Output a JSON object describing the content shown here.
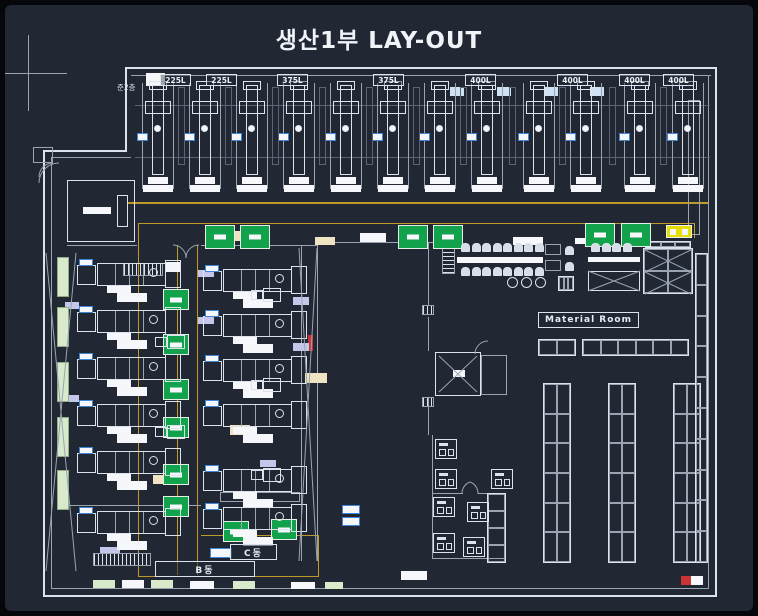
{
  "title": "생산1부 LAY-OUT",
  "labels": {
    "mezzanine": "준2층",
    "material_room": "Material Room",
    "block_b": "B동",
    "block_c": "C동"
  },
  "machine_labels": [
    {
      "x": 155,
      "text": "225L"
    },
    {
      "x": 201,
      "text": "225L"
    },
    {
      "x": 272,
      "text": "375L"
    },
    {
      "x": 368,
      "text": "375L"
    },
    {
      "x": 460,
      "text": "400L"
    },
    {
      "x": 552,
      "text": "400L"
    },
    {
      "x": 614,
      "text": "400L"
    },
    {
      "x": 658,
      "text": "400L"
    }
  ],
  "colors": {
    "bg": "#212834",
    "line": "#dde3ec",
    "dim": "#9aa4b2",
    "dim2": "#5a6472",
    "yellow": "#c09a26",
    "green": "#12a24b",
    "palegreen": "#d8e9cc",
    "blue": "#3f86d8",
    "paleblue": "#cfe2f3",
    "lavender": "#c6c6ea",
    "tan": "#efe3c4",
    "red": "#c93434",
    "white": "#f5f7fa"
  },
  "plan": {
    "crosshair": {
      "h": [
        0,
        68,
        62,
        1
      ],
      "v": [
        23,
        30,
        1,
        76
      ]
    },
    "top_machines": {
      "y": 76,
      "w": 34,
      "h": 112,
      "xs": [
        136,
        183,
        230,
        277,
        324,
        371,
        418,
        465,
        517,
        564,
        618,
        666
      ]
    },
    "side_machines": [
      [
        72,
        252
      ],
      [
        72,
        299
      ],
      [
        72,
        346
      ],
      [
        72,
        393
      ],
      [
        72,
        440
      ],
      [
        72,
        500
      ],
      [
        198,
        258
      ],
      [
        198,
        303
      ],
      [
        198,
        348
      ],
      [
        198,
        393
      ],
      [
        198,
        458
      ],
      [
        198,
        496
      ]
    ],
    "small_machines": [
      [
        430,
        434
      ],
      [
        430,
        464
      ],
      [
        428,
        492
      ],
      [
        428,
        528
      ],
      [
        462,
        497
      ],
      [
        458,
        532
      ],
      [
        486,
        464
      ]
    ],
    "pumps": [
      [
        150,
        330
      ],
      [
        150,
        420
      ],
      [
        246,
        283
      ],
      [
        246,
        373
      ],
      [
        246,
        463
      ]
    ],
    "pallets": [
      [
        200,
        220,
        30,
        24
      ],
      [
        235,
        220,
        30,
        24
      ],
      [
        393,
        220,
        30,
        24
      ],
      [
        428,
        220,
        30,
        24
      ],
      [
        580,
        218,
        30,
        24
      ],
      [
        616,
        218,
        30,
        24
      ],
      [
        158,
        284,
        26,
        21
      ],
      [
        158,
        329,
        26,
        21
      ],
      [
        158,
        374,
        26,
        21
      ],
      [
        158,
        412,
        26,
        21
      ],
      [
        158,
        459,
        26,
        21
      ],
      [
        158,
        491,
        26,
        21
      ],
      [
        218,
        516,
        26,
        21
      ],
      [
        266,
        514,
        26,
        21
      ]
    ],
    "pallet_yellow": [
      661,
      220,
      26,
      13
    ],
    "strips": [
      [
        52,
        252
      ],
      [
        52,
        302
      ],
      [
        52,
        357
      ],
      [
        52,
        412
      ],
      [
        52,
        465
      ]
    ],
    "lines": [
      [
        120,
        62,
        592,
        2,
        "line"
      ],
      [
        126,
        70,
        580,
        1,
        "dim"
      ],
      [
        710,
        62,
        2,
        530,
        "line"
      ],
      [
        703,
        70,
        1,
        514,
        "dim"
      ],
      [
        38,
        590,
        674,
        2,
        "line"
      ],
      [
        46,
        583,
        658,
        1,
        "dim"
      ],
      [
        38,
        145,
        2,
        447,
        "line"
      ],
      [
        46,
        152,
        1,
        431,
        "dim"
      ],
      [
        38,
        145,
        84,
        2,
        "line"
      ],
      [
        46,
        152,
        80,
        1,
        "dim"
      ],
      [
        120,
        62,
        2,
        85,
        "line"
      ],
      [
        130,
        100,
        575,
        1,
        "dim2"
      ],
      [
        130,
        152,
        575,
        1,
        "dim2"
      ],
      [
        122,
        197,
        581,
        2,
        "yellow"
      ],
      [
        133,
        218,
        557,
        1,
        "yellow"
      ],
      [
        133,
        218,
        1,
        354,
        "yellow"
      ],
      [
        172,
        240,
        1,
        330,
        "yellow"
      ],
      [
        192,
        240,
        1,
        330,
        "yellow"
      ],
      [
        689,
        218,
        1,
        15,
        "yellow"
      ],
      [
        196,
        530,
        118,
        1,
        "yellow"
      ],
      [
        133,
        571,
        181,
        1,
        "yellow"
      ],
      [
        313,
        530,
        1,
        42,
        "yellow"
      ],
      [
        312,
        237,
        140,
        1,
        "dim"
      ],
      [
        296,
        240,
        1,
        316,
        "dim"
      ],
      [
        312,
        240,
        1,
        316,
        "dim"
      ],
      [
        423,
        238,
        1,
        62,
        "dim"
      ],
      [
        423,
        312,
        1,
        34,
        "dim"
      ],
      [
        423,
        392,
        1,
        38,
        "dim"
      ],
      [
        427,
        430,
        1,
        123,
        "dim"
      ],
      [
        427,
        553,
        74,
        1,
        "dim"
      ],
      [
        428,
        488,
        30,
        1,
        "dim"
      ],
      [
        473,
        488,
        28,
        1,
        "dim"
      ],
      [
        62,
        500,
        134,
        1,
        "dim"
      ],
      [
        62,
        240,
        70,
        1,
        "dim"
      ],
      [
        196,
        240,
        116,
        1,
        "dim"
      ]
    ],
    "rects": [
      [
        62,
        175,
        68,
        62,
        "line"
      ],
      [
        112,
        190,
        11,
        32,
        "line"
      ],
      [
        430,
        347,
        46,
        44,
        "line"
      ],
      [
        476,
        350,
        26,
        40,
        "dim"
      ],
      [
        683,
        95,
        12,
        135,
        "dim"
      ],
      [
        215,
        487,
        80,
        10,
        "dim"
      ],
      [
        540,
        239,
        16,
        11,
        "dim"
      ],
      [
        540,
        255,
        16,
        11,
        "dim"
      ],
      [
        583,
        266,
        52,
        20,
        "line"
      ],
      [
        28,
        142,
        20,
        16,
        "dim"
      ]
    ],
    "fills": [
      [
        141,
        68,
        19,
        13,
        "white"
      ],
      [
        78,
        202,
        28,
        7,
        "white"
      ],
      [
        160,
        257,
        16,
        10,
        "white"
      ],
      [
        452,
        252,
        86,
        6,
        "white"
      ],
      [
        583,
        252,
        52,
        5,
        "white"
      ],
      [
        355,
        228,
        26,
        9,
        "white"
      ],
      [
        508,
        232,
        30,
        8,
        "white"
      ],
      [
        570,
        233,
        34,
        6,
        "white"
      ],
      [
        448,
        365,
        12,
        7,
        "white"
      ],
      [
        88,
        575,
        22,
        8,
        "palegreen"
      ],
      [
        117,
        575,
        22,
        8,
        "white"
      ],
      [
        146,
        575,
        22,
        8,
        "palegreen"
      ],
      [
        185,
        576,
        24,
        8,
        "white"
      ],
      [
        228,
        576,
        22,
        8,
        "palegreen"
      ],
      [
        286,
        577,
        24,
        7,
        "white"
      ],
      [
        320,
        577,
        18,
        7,
        "palegreen"
      ],
      [
        396,
        566,
        26,
        9,
        "white"
      ],
      [
        676,
        571,
        22,
        9,
        "white"
      ],
      [
        676,
        571,
        10,
        9,
        "red"
      ],
      [
        303,
        330,
        5,
        16,
        "red"
      ],
      [
        193,
        265,
        16,
        7,
        "lavender"
      ],
      [
        193,
        312,
        16,
        7,
        "lavender"
      ],
      [
        60,
        297,
        14,
        7,
        "lavender"
      ],
      [
        60,
        390,
        14,
        7,
        "lavender"
      ],
      [
        288,
        292,
        16,
        8,
        "lavender"
      ],
      [
        288,
        338,
        16,
        8,
        "lavender"
      ],
      [
        95,
        542,
        20,
        7,
        "lavender"
      ],
      [
        255,
        455,
        16,
        7,
        "lavender"
      ],
      [
        225,
        420,
        20,
        10,
        "tan"
      ],
      [
        300,
        368,
        22,
        10,
        "tan"
      ],
      [
        148,
        470,
        18,
        9,
        "tan"
      ],
      [
        228,
        226,
        26,
        10,
        "tan"
      ],
      [
        310,
        232,
        20,
        8,
        "tan"
      ],
      [
        445,
        82,
        14,
        9,
        "paleblue"
      ],
      [
        492,
        82,
        14,
        9,
        "paleblue"
      ],
      [
        539,
        82,
        14,
        9,
        "paleblue"
      ],
      [
        585,
        82,
        14,
        9,
        "paleblue"
      ]
    ],
    "bluebits": [
      [
        337,
        500,
        18,
        9
      ],
      [
        337,
        512,
        18,
        9
      ],
      [
        205,
        543,
        22,
        10
      ]
    ],
    "hatches": [
      [
        437,
        242,
        13,
        27,
        "h"
      ],
      [
        88,
        548,
        58,
        13,
        "v"
      ],
      [
        118,
        258,
        40,
        13,
        "v"
      ],
      [
        417,
        300,
        12,
        10,
        "v"
      ],
      [
        417,
        392,
        12,
        10,
        "v"
      ]
    ],
    "racks": [
      [
        533,
        334,
        38,
        17,
        2,
        1
      ],
      [
        577,
        334,
        107,
        17,
        6,
        1
      ],
      [
        538,
        378,
        28,
        180,
        2,
        6
      ],
      [
        603,
        378,
        28,
        180,
        2,
        6
      ],
      [
        668,
        378,
        28,
        180,
        2,
        6
      ],
      [
        690,
        248,
        13,
        310,
        1,
        10
      ],
      [
        638,
        243,
        50,
        46,
        2,
        2
      ],
      [
        640,
        236,
        46,
        7,
        3,
        1
      ],
      [
        482,
        488,
        19,
        70,
        1,
        4
      ],
      [
        553,
        271,
        16,
        15,
        3,
        1
      ]
    ],
    "chair_rows": [
      [
        456,
        238,
        8,
        10.5
      ],
      [
        456,
        262,
        8,
        10.5
      ],
      [
        586,
        238,
        4,
        10.5
      ],
      [
        560,
        241,
        1,
        0
      ],
      [
        560,
        257,
        1,
        0
      ]
    ],
    "stools": [
      [
        502,
        272,
        11
      ],
      [
        516,
        272,
        11
      ],
      [
        530,
        272,
        11
      ]
    ],
    "diagonals": [
      [
        41,
        248,
        71,
        566
      ],
      [
        71,
        248,
        41,
        566
      ],
      [
        294,
        243,
        312,
        556
      ],
      [
        312,
        243,
        294,
        556
      ],
      [
        434,
        351,
        472,
        387
      ],
      [
        472,
        351,
        434,
        387
      ],
      [
        583,
        266,
        635,
        286
      ],
      [
        635,
        266,
        583,
        286
      ],
      [
        640,
        245,
        686,
        267
      ],
      [
        686,
        245,
        640,
        267
      ],
      [
        640,
        267,
        686,
        289
      ],
      [
        686,
        267,
        640,
        289
      ]
    ],
    "arcs": [
      "M54,158 A20,20 0 0 0 34,178",
      "M48,158 A14,14 0 0 0 34,172",
      "M168,240 A13,13 0 0 1 181,253",
      "M194,240 A13,13 0 0 0 181,253",
      "M457,489 A12,12 0 0 1 465,477",
      "M473,489 A12,12 0 0 0 465,477",
      "M470,349 A13,13 0 0 1 483,336"
    ]
  }
}
